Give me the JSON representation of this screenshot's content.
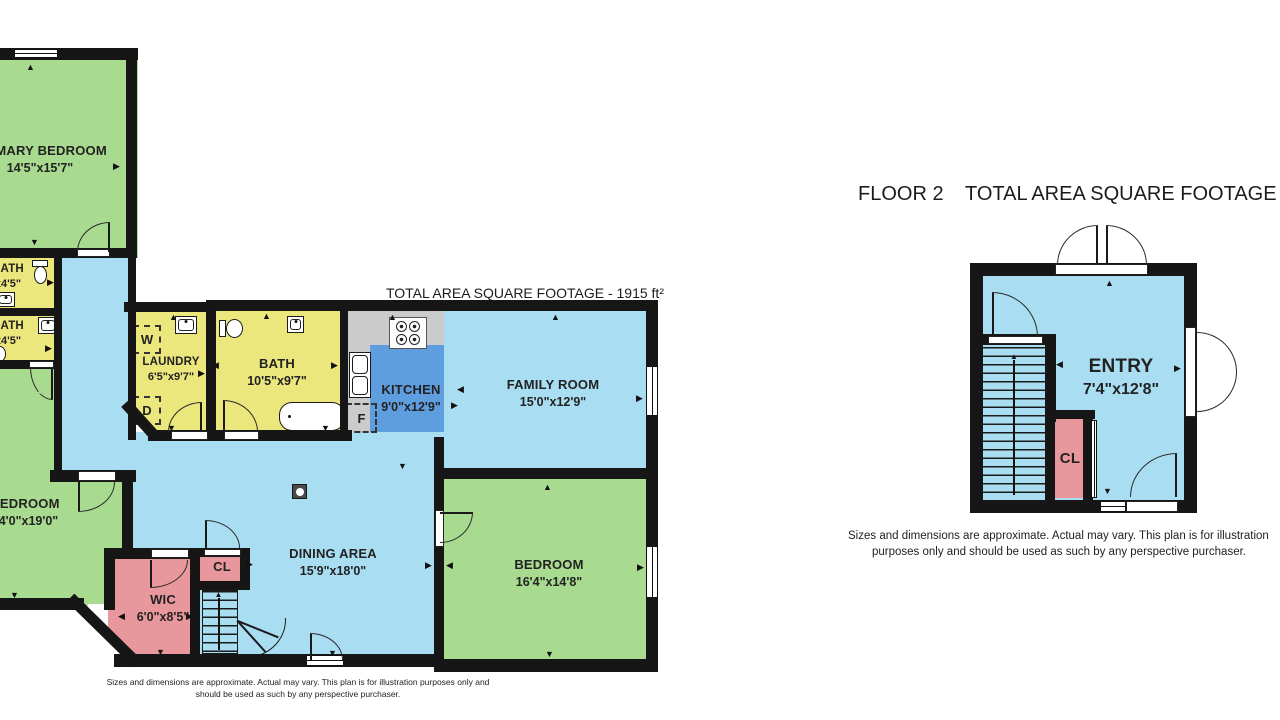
{
  "floor1": {
    "area_title": "TOTAL AREA SQUARE FOOTAGE - 1915 ft²",
    "rooms": {
      "primary_bedroom": {
        "name": "PRIMARY BEDROOM",
        "dims": "14'5\"x15'7\""
      },
      "bath_upper": {
        "name": "BATH",
        "dims": "x4'5\""
      },
      "bath_lower": {
        "name": "BATH",
        "dims": "x4'5\""
      },
      "laundry": {
        "name": "LAUNDRY",
        "dims": "6'5\"x9'7\""
      },
      "bath_main": {
        "name": "BATH",
        "dims": "10'5\"x9'7\""
      },
      "kitchen": {
        "name": "KITCHEN",
        "dims": "9'0\"x12'9\""
      },
      "family_room": {
        "name": "FAMILY ROOM",
        "dims": "15'0\"x12'9\""
      },
      "dining_area": {
        "name": "DINING AREA",
        "dims": "15'9\"x18'0\""
      },
      "bedroom_left": {
        "name": "BEDROOM",
        "dims": "14'0\"x19'0\""
      },
      "bedroom_right": {
        "name": "BEDROOM",
        "dims": "16'4\"x14'8\""
      },
      "wic": {
        "name": "WIC",
        "dims": "6'0\"x8'5\""
      },
      "closet": {
        "name": "CL"
      }
    },
    "appliances": {
      "washer": "W",
      "dryer": "D",
      "fridge": "F"
    },
    "disclaimer": [
      "Sizes and dimensions are approximate. Actual may vary. This plan is for illustration purposes only and",
      "should be used as such by any perspective purchaser."
    ]
  },
  "floor2": {
    "title": "FLOOR 2",
    "area_title": "TOTAL AREA SQUARE FOOTAGE -",
    "rooms": {
      "entry": {
        "name": "ENTRY",
        "dims": "7'4\"x12'8\""
      },
      "closet": {
        "name": "CL"
      }
    },
    "disclaimer": [
      "Sizes and dimensions are approximate. Actual may vary. This plan is for illustration",
      "purposes only and should be used as such by any perspective purchaser."
    ]
  },
  "icons": {
    "arrow_up": "▲",
    "arrow_down": "▼",
    "arrow_left": "◀",
    "arrow_right": "▶"
  },
  "colors": {
    "room_green": "#a8db90",
    "room_yellow": "#ebe77d",
    "room_blue": "#a9def2",
    "kitchen_blue": "#5e9edf",
    "counter_gray": "#cbcbcb",
    "closet_pink": "#e8989c",
    "wall": "#161616"
  }
}
